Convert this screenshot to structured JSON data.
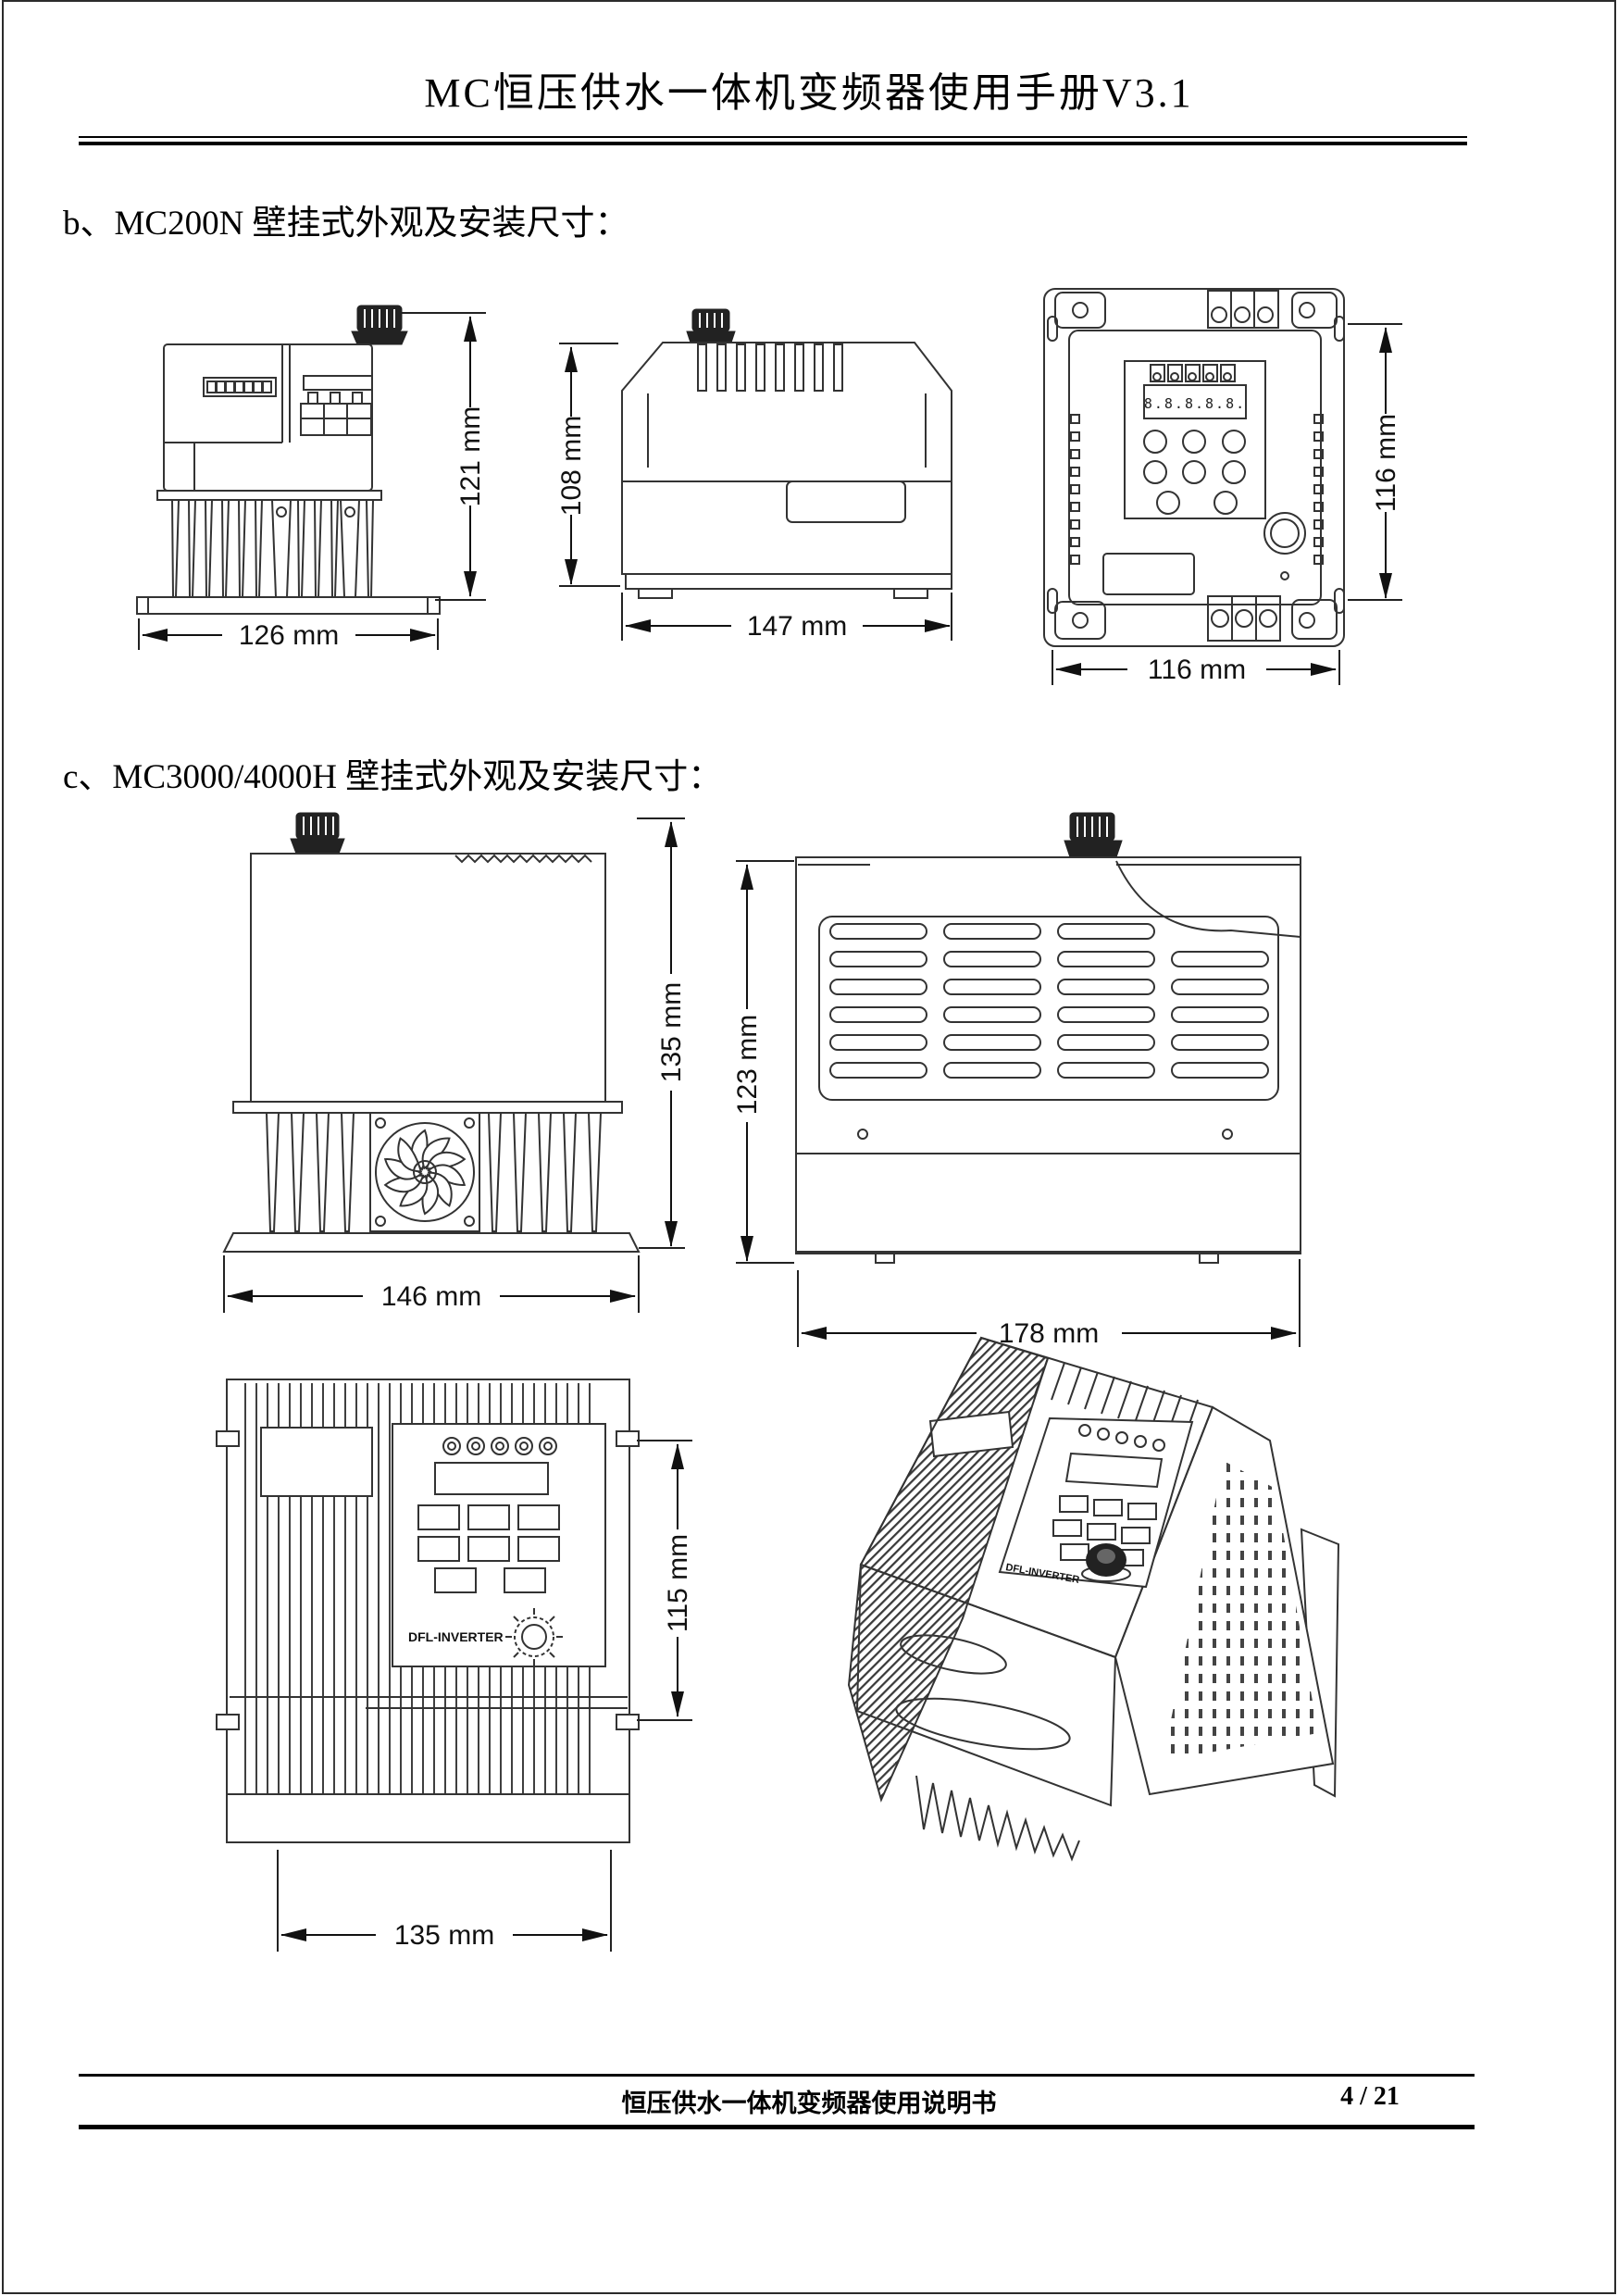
{
  "header": {
    "title": "MC恒压供水一体机变频器使用手册V3.1"
  },
  "sections": {
    "b": {
      "heading": "b、MC200N 壁挂式外观及安装尺寸："
    },
    "c": {
      "heading": "c、MC3000/4000H 壁挂式外观及安装尺寸："
    }
  },
  "drawings": {
    "mc200n_front": {
      "height": "121 mm",
      "width": "126 mm"
    },
    "mc200n_side": {
      "height": "108 mm",
      "width": "147 mm"
    },
    "mc200n_back": {
      "height": "116 mm",
      "width": "116 mm",
      "display_digits": "8.8.8.8.8."
    },
    "mc3000_front": {
      "height": "135 mm",
      "width": "146 mm"
    },
    "mc3000_side": {
      "height": "123 mm",
      "width": "178 mm"
    },
    "mc3000_top": {
      "height": "115 mm",
      "width": "135 mm"
    }
  },
  "labels": {
    "brand": "DFL-INVERTER"
  },
  "footer": {
    "doc_title": "恒压供水一体机变频器使用说明书",
    "page_number": "4 / 21"
  }
}
